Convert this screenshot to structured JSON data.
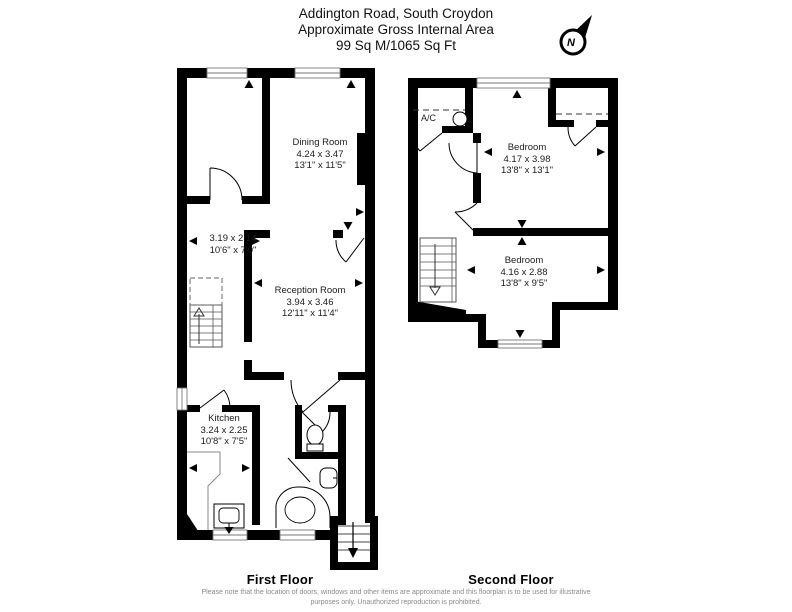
{
  "header": {
    "line1": "Addington Road, South Croydon",
    "line2": "Approximate Gross Internal Area",
    "line3": "99 Sq M/1065 Sq Ft"
  },
  "compass": {
    "label": "N"
  },
  "first_floor": {
    "label": "First Floor",
    "rooms": {
      "store": {
        "metric": "3.19 x 2.14",
        "imperial": "10'6\" x 7'0\""
      },
      "dining": {
        "name": "Dining Room",
        "metric": "4.24 x 3.47",
        "imperial": "13'1\" x 11'5\""
      },
      "reception": {
        "name": "Reception Room",
        "metric": "3.94 x 3.46",
        "imperial": "12'11\" x 11'4\""
      },
      "kitchen": {
        "name": "Kitchen",
        "metric": "3.24 x 2.25",
        "imperial": "10'8\" x 7'5\""
      }
    }
  },
  "second_floor": {
    "label": "Second Floor",
    "ac_label": "A/C",
    "rooms": {
      "bedroom1": {
        "name": "Bedroom",
        "metric": "4.17 x 3.98",
        "imperial": "13'8\" x 13'1\""
      },
      "bedroom2": {
        "name": "Bedroom",
        "metric": "4.16 x 2.88",
        "imperial": "13'8\" x 9'5\""
      }
    }
  },
  "footer": {
    "disclaimer_line1": "Please note that the location of doors, windows and other items are approximate and this floorplan is to be used for illustrative",
    "disclaimer_line2": "purposes only. Unauthorized reproduction is prohibited."
  }
}
